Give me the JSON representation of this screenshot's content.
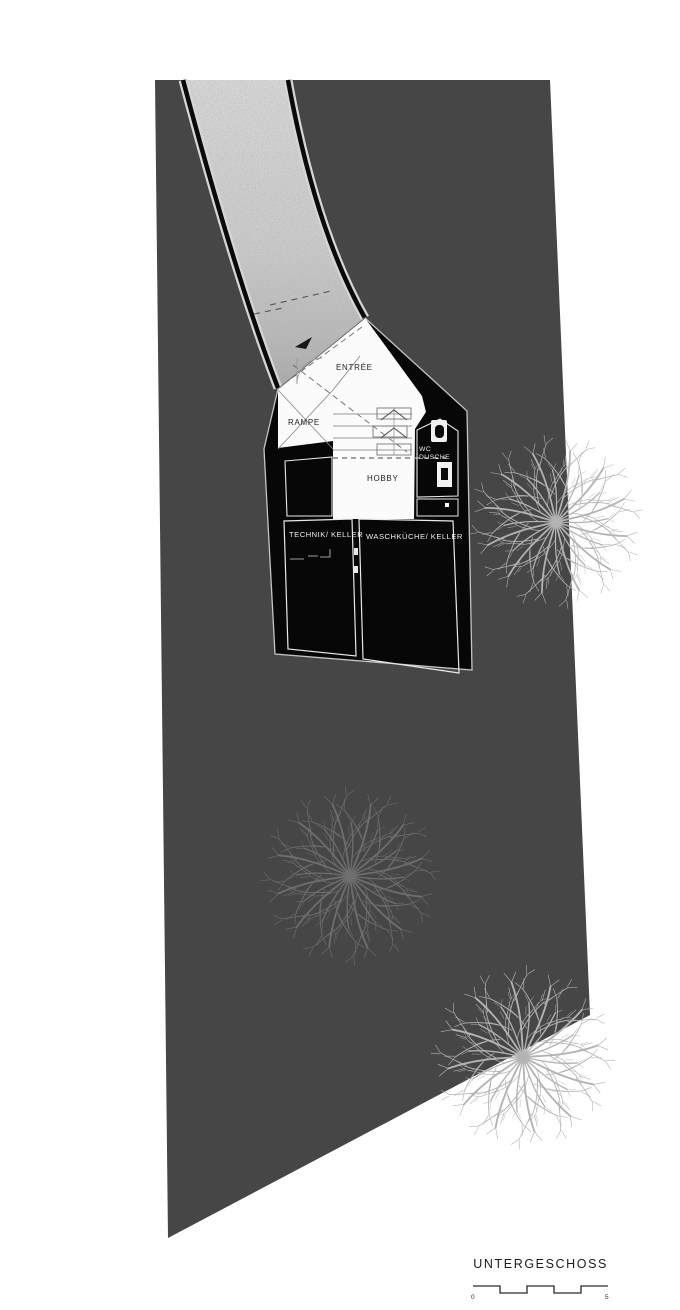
{
  "plan": {
    "title": "UNTERGESCHOSS",
    "rooms": {
      "entree": {
        "label": "ENTRÉE"
      },
      "rampe": {
        "label": "RAMPE"
      },
      "wc": {
        "line1": "WC",
        "line2": "DUSCHE"
      },
      "hobby": {
        "label": "HOBBY"
      },
      "technik": {
        "label": "TECHNIK/ KELLER"
      },
      "waschkueche": {
        "label": "WASCHKÜCHE/ KELLER"
      }
    },
    "scale_bar": {
      "start_label": "0",
      "end_label": "5"
    },
    "trees_visible": 5,
    "colors": {
      "site_fill": "#464646",
      "building_fill": "#070707",
      "room_white": "#fbfbfb",
      "driveway_light": "#ececec",
      "tree_on_dark": "#757575",
      "tree_on_white": "#b3b3b3"
    }
  }
}
